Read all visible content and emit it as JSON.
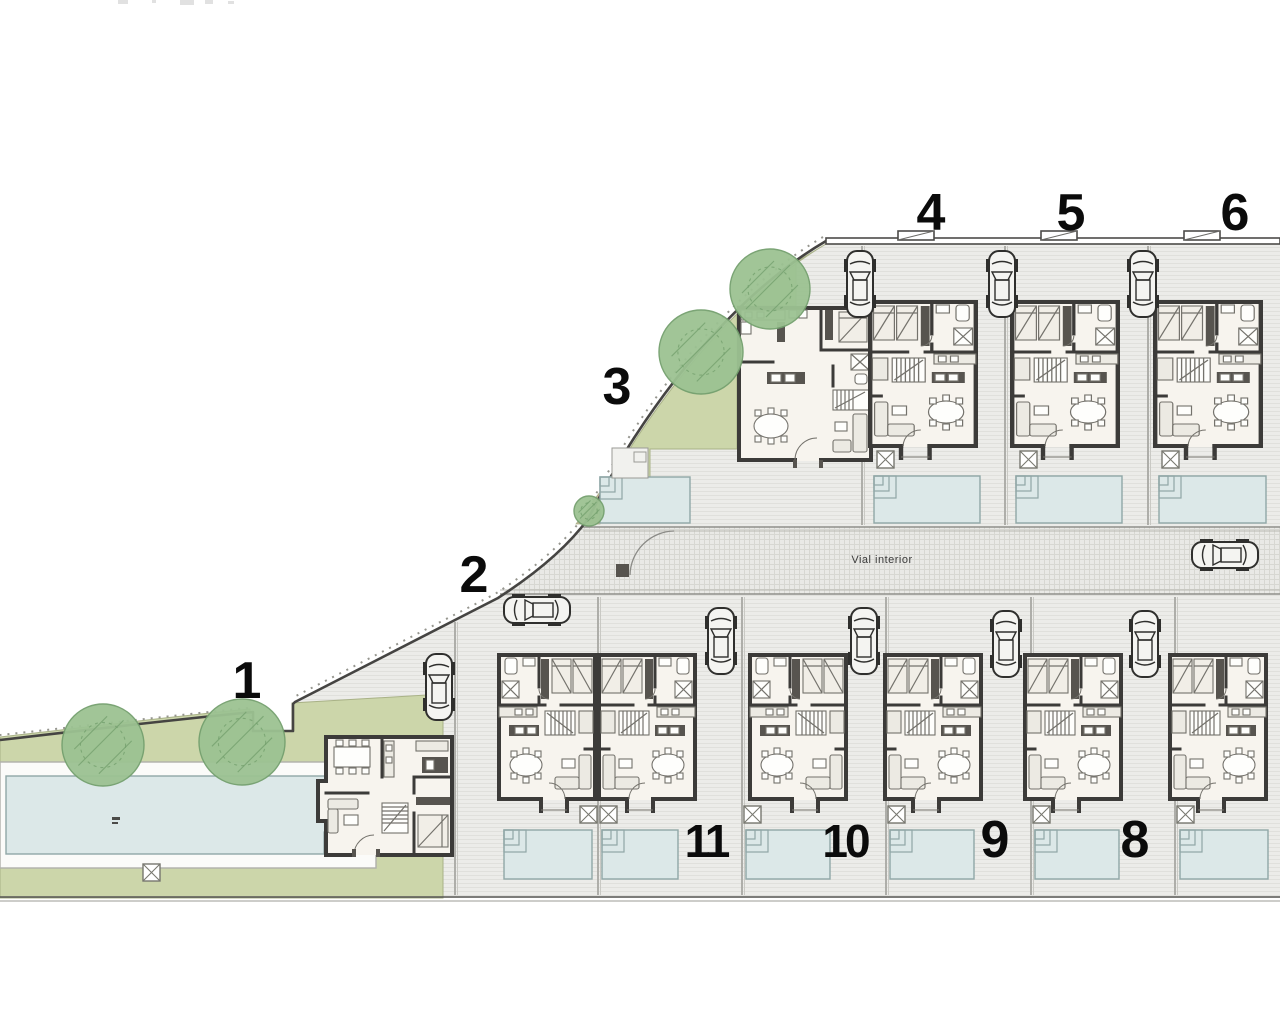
{
  "road": {
    "label": "Vial interior"
  },
  "site": {
    "plot_numbers": [
      {
        "id": "1",
        "label": "1",
        "x": 247,
        "y": 698
      },
      {
        "id": "2",
        "label": "2",
        "x": 474,
        "y": 592
      },
      {
        "id": "3",
        "label": "3",
        "x": 617,
        "y": 404
      },
      {
        "id": "4",
        "label": "4",
        "x": 931,
        "y": 230
      },
      {
        "id": "5",
        "label": "5",
        "x": 1071,
        "y": 230
      },
      {
        "id": "6",
        "label": "6",
        "x": 1235,
        "y": 230
      },
      {
        "id": "8",
        "label": "8",
        "x": 1135,
        "y": 857
      },
      {
        "id": "9",
        "label": "9",
        "x": 995,
        "y": 857
      },
      {
        "id": "10",
        "label": "10",
        "x": 845,
        "y": 857
      },
      {
        "id": "11",
        "label": "11",
        "x": 706,
        "y": 857
      }
    ],
    "row_houses": [
      {
        "name": "house-4-plan",
        "x": 868,
        "y": 300,
        "w": 110,
        "h": 150,
        "mirror": false
      },
      {
        "name": "house-5-plan",
        "x": 1010,
        "y": 300,
        "w": 110,
        "h": 150,
        "mirror": false
      },
      {
        "name": "house-6-plan",
        "x": 1153,
        "y": 300,
        "w": 110,
        "h": 150,
        "mirror": false
      },
      {
        "name": "house-2-plan",
        "x": 497,
        "y": 653,
        "w": 100,
        "h": 150,
        "mirror": true
      },
      {
        "name": "house-11-plan",
        "x": 597,
        "y": 653,
        "w": 100,
        "h": 150,
        "mirror": false
      },
      {
        "name": "house-10-plan",
        "x": 748,
        "y": 653,
        "w": 100,
        "h": 150,
        "mirror": true
      },
      {
        "name": "house-9-plan",
        "x": 883,
        "y": 653,
        "w": 100,
        "h": 150,
        "mirror": false
      },
      {
        "name": "house-8-plan",
        "x": 1023,
        "y": 653,
        "w": 100,
        "h": 150,
        "mirror": false
      },
      {
        "name": "house-7-plan",
        "x": 1168,
        "y": 653,
        "w": 100,
        "h": 150,
        "mirror": false
      }
    ],
    "cars": [
      {
        "name": "car-top-1",
        "x": 845,
        "y": 250,
        "rot": 0
      },
      {
        "name": "car-top-2",
        "x": 987,
        "y": 250,
        "rot": 0
      },
      {
        "name": "car-top-3",
        "x": 1128,
        "y": 250,
        "rot": 0
      },
      {
        "name": "car-house-1",
        "x": 424,
        "y": 653,
        "rot": 0
      },
      {
        "name": "car-house-2",
        "x": 522,
        "y": 576,
        "rot": -90
      },
      {
        "name": "car-bottom-1",
        "x": 706,
        "y": 607,
        "rot": 0
      },
      {
        "name": "car-bottom-2",
        "x": 849,
        "y": 607,
        "rot": 0
      },
      {
        "name": "car-bottom-3",
        "x": 991,
        "y": 610,
        "rot": 0
      },
      {
        "name": "car-bottom-4",
        "x": 1130,
        "y": 610,
        "rot": 0
      },
      {
        "name": "car-road",
        "x": 1210,
        "y": 521,
        "rot": -90
      }
    ],
    "pools": [
      {
        "name": "community-pool",
        "deck": {
          "x": 0,
          "y": 762,
          "w": 376,
          "h": 106
        },
        "x": 6,
        "y": 776,
        "w": 340,
        "h": 78,
        "steps": "br",
        "smudge": true
      },
      {
        "name": "pool-house-3",
        "x": 600,
        "y": 477,
        "w": 90,
        "h": 46,
        "steps": "tl"
      },
      {
        "name": "pool-house-4",
        "x": 874,
        "y": 476,
        "w": 106,
        "h": 47,
        "steps": "tl"
      },
      {
        "name": "pool-house-5",
        "x": 1016,
        "y": 476,
        "w": 106,
        "h": 47,
        "steps": "tl"
      },
      {
        "name": "pool-house-6",
        "x": 1159,
        "y": 476,
        "w": 107,
        "h": 47,
        "steps": "tl"
      },
      {
        "name": "pool-house-2",
        "x": 504,
        "y": 830,
        "w": 88,
        "h": 49,
        "steps": "tl"
      },
      {
        "name": "pool-house-11",
        "x": 602,
        "y": 830,
        "w": 76,
        "h": 49,
        "steps": "tl"
      },
      {
        "name": "pool-house-10",
        "x": 746,
        "y": 830,
        "w": 84,
        "h": 49,
        "steps": "tl"
      },
      {
        "name": "pool-house-9",
        "x": 890,
        "y": 830,
        "w": 84,
        "h": 49,
        "steps": "tl"
      },
      {
        "name": "pool-house-8",
        "x": 1035,
        "y": 830,
        "w": 84,
        "h": 49,
        "steps": "tl"
      },
      {
        "name": "pool-house-7",
        "x": 1180,
        "y": 830,
        "w": 88,
        "h": 49,
        "steps": "tl"
      }
    ],
    "trees": [
      {
        "x": 103,
        "y": 745,
        "r": 41
      },
      {
        "x": 242,
        "y": 742,
        "r": 43
      },
      {
        "x": 770,
        "y": 289,
        "r": 40
      },
      {
        "x": 701,
        "y": 352,
        "r": 42
      },
      {
        "x": 589,
        "y": 511,
        "r": 15
      }
    ],
    "utility_boxes": [
      {
        "x": 877,
        "y": 451
      },
      {
        "x": 1020,
        "y": 451
      },
      {
        "x": 1162,
        "y": 451
      },
      {
        "x": 580,
        "y": 806
      },
      {
        "x": 600,
        "y": 806
      },
      {
        "x": 744,
        "y": 806
      },
      {
        "x": 888,
        "y": 806
      },
      {
        "x": 1033,
        "y": 806
      },
      {
        "x": 1177,
        "y": 806
      },
      {
        "x": 143,
        "y": 864
      }
    ],
    "dividers": [
      {
        "x": 862,
        "y1": 246,
        "y2": 525
      },
      {
        "x": 1005,
        "y1": 246,
        "y2": 525
      },
      {
        "x": 1148,
        "y1": 246,
        "y2": 525
      },
      {
        "x": 455,
        "y1": 622,
        "y2": 895
      },
      {
        "x": 598,
        "y1": 597,
        "y2": 895
      },
      {
        "x": 742,
        "y1": 597,
        "y2": 895
      },
      {
        "x": 886,
        "y1": 597,
        "y2": 895
      },
      {
        "x": 1031,
        "y1": 597,
        "y2": 895
      },
      {
        "x": 1175,
        "y1": 597,
        "y2": 895
      }
    ],
    "top_fence_gates": [
      {
        "x": 898
      },
      {
        "x": 1041
      },
      {
        "x": 1184
      }
    ]
  },
  "colors": {
    "paving_bg": "#ecece9",
    "paving_line": "#e0e0dc",
    "road_bg": "#e9e9e6",
    "road_line": "#d7d7d2",
    "green": "#ccd6aa",
    "green_edge": "#a9b287",
    "tree": "#9cc292",
    "tree_edge": "#74a06e",
    "tan": "#c8b49c",
    "pool": "#dce8e8",
    "pool_edge": "#90a7a7",
    "deck": "#fbfbf9",
    "deck_edge": "#b0b0ab",
    "wall": "#3c3b39",
    "floor": "#f7f4ee",
    "furn": "#74726c",
    "furn_fill": "#fefefc",
    "soft": "#eceae3",
    "bed": "#f1eee7",
    "dark": "#57544f",
    "boundary": "#454442",
    "fence": "#4c4b49",
    "divider": "#a8a8a3",
    "number": "#0b0b0b",
    "label": "#3a3a3a",
    "box": "#77776f"
  }
}
